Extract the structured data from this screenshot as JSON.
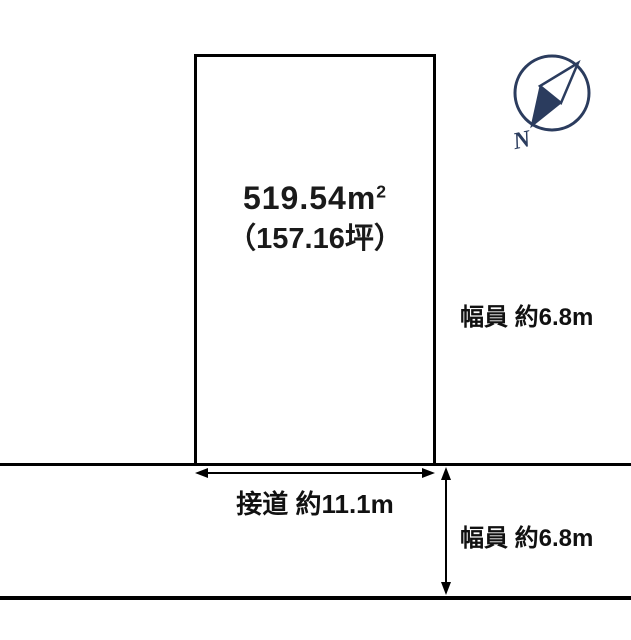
{
  "plot": {
    "area_base": "519.54m",
    "area_sup": "2",
    "area_tsubo": "（157.16坪）"
  },
  "labels": {
    "frontage": "接道 約11.1m",
    "road_width_right": "幅員 約6.8m",
    "road_width_bottom": "幅員 約6.8m"
  },
  "compass": {
    "n_label": "N"
  },
  "colors": {
    "line": "#000000",
    "text": "#111111",
    "compass": "#2b3c5e"
  }
}
